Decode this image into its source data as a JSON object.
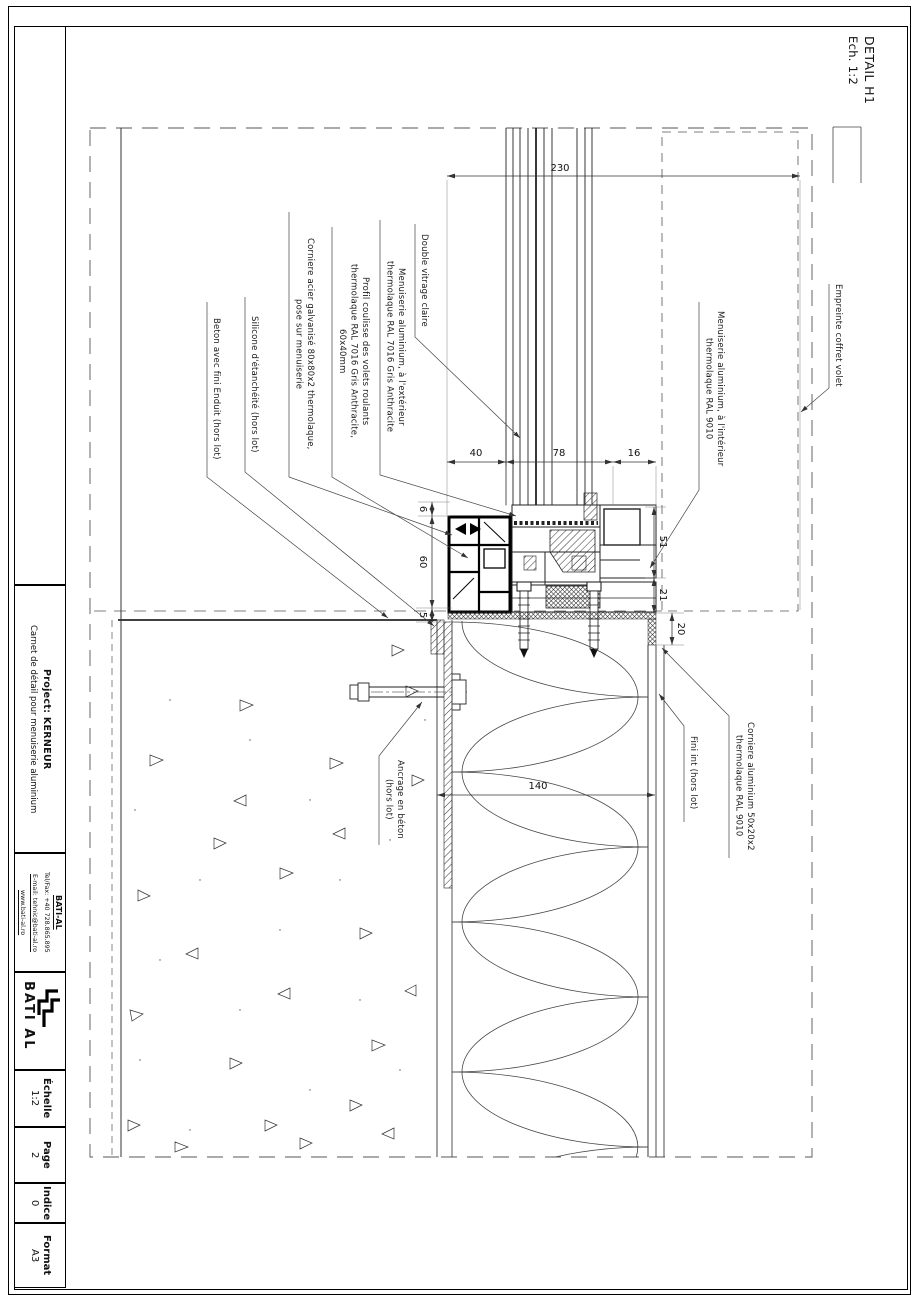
{
  "sheet": {
    "detail_title": "DETAIL H1",
    "detail_scale": "Ech. 1:2"
  },
  "titleblock": {
    "project_label": "Project: ",
    "project_name": "KERNEUR",
    "project_description": "Carnet de détail pour menuiserie aluminium",
    "company_name": "BATI-AL",
    "company_tel": "Tel/Fax: +40 728.865.895",
    "company_email": "E-mail: tehnic@bati-al.ro",
    "company_web": "www.bati-al.ro",
    "logo_text": "BATI AL",
    "scale_label": "Échelle",
    "scale_value": "1:2",
    "page_label": "Page",
    "page_value": "2",
    "indice_label": "Indice",
    "indice_value": "0",
    "format_label": "Format",
    "format_value": "A3"
  },
  "annotations": {
    "beton": "Beton avec fini Enduit (hors lot)",
    "silicone": "Silicone d'étanchéité (hors lot)",
    "corniere_acier_1": "Corniere acier galvanisé 80x80x2 thermolaque,",
    "corniere_acier_2": "pose sur menuiserie",
    "profil_1": "Profil coulisse des volets roulants",
    "profil_2": "thermolaque RAL 7016 Gris Anthracite,",
    "profil_3": "60x40mm",
    "men_ext_1": "Menuiserie aluminium, à l'extérieur",
    "men_ext_2": "thermolaque RAL 7016 Gris Anthracite",
    "vitrage": "Double vitrage claire",
    "men_int_1": "Menuiserie aluminium, à l'intérieur",
    "men_int_2": "thermolaque RAL 9010",
    "empreinte": "Empreinte coffret volet",
    "corniere_alu_1": "Corniere aluminium 50x20x2",
    "corniere_alu_2": "thermolaque RAL 9010",
    "fini_int": "Fini int (hors lot)",
    "ancrage_1": "Ancrage en béton",
    "ancrage_2": "(hors lot)"
  },
  "dimensions": {
    "d230": "230",
    "d40": "40",
    "d78": "78",
    "d16": "16",
    "d6": "6",
    "d60": "60",
    "d5": "5",
    "d51": "51",
    "d21": "21",
    "d20": "20",
    "d140": "140"
  }
}
